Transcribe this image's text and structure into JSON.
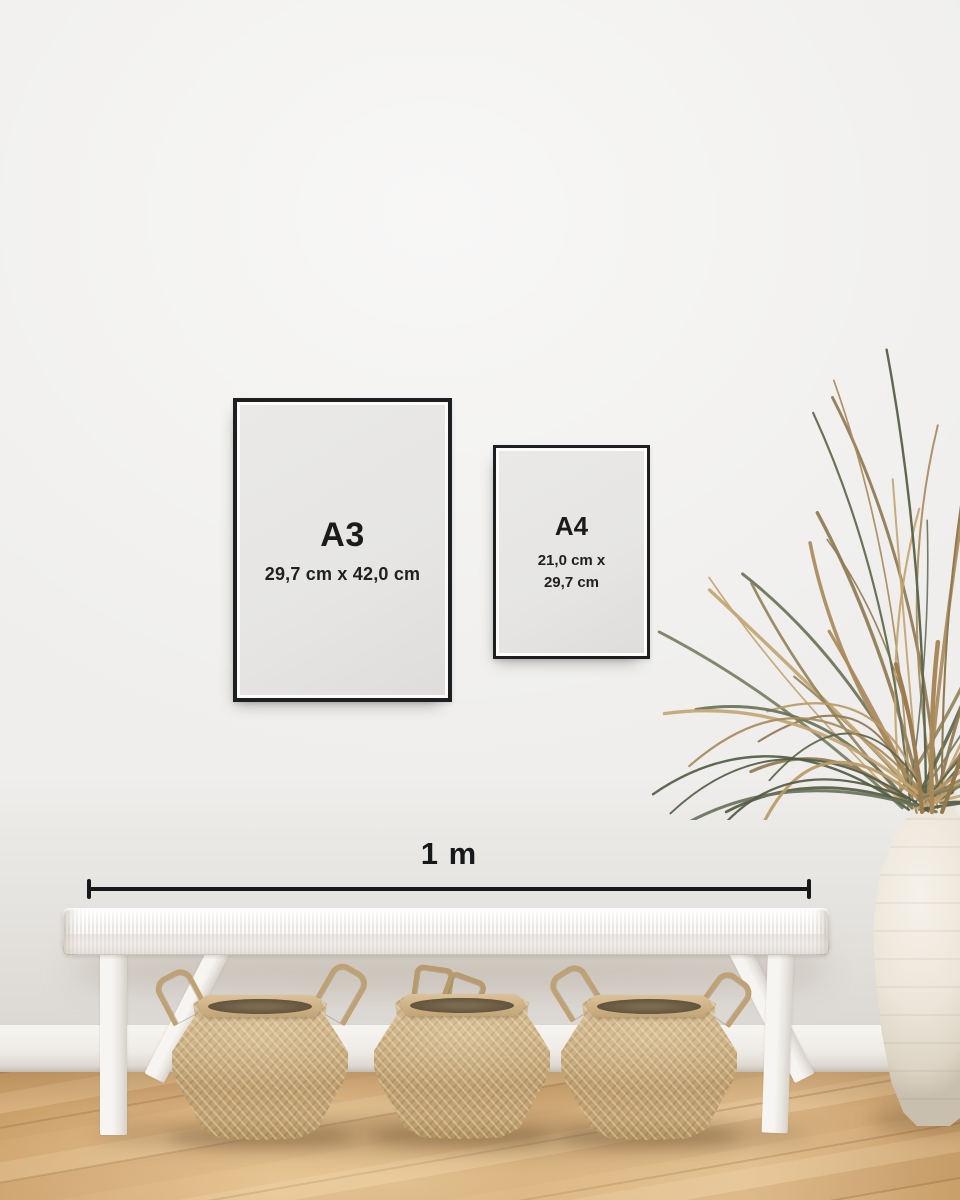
{
  "posters": {
    "a3": {
      "label": "A3",
      "dimensions": "29,7 cm x 42,0 cm"
    },
    "a4": {
      "label": "A4",
      "dimensions_line1": "21,0 cm x",
      "dimensions_line2": "29,7 cm"
    }
  },
  "measurement": {
    "label": "1 m"
  },
  "colors": {
    "wall": "#efeeec",
    "frame": "#1d1f21",
    "paper": "#e6e5e3",
    "ink": "#17181a",
    "floor-mid": "#d2aa74",
    "basket": "#c5a878",
    "bench": "#f6f4f1",
    "vase": "#ece5d9"
  }
}
